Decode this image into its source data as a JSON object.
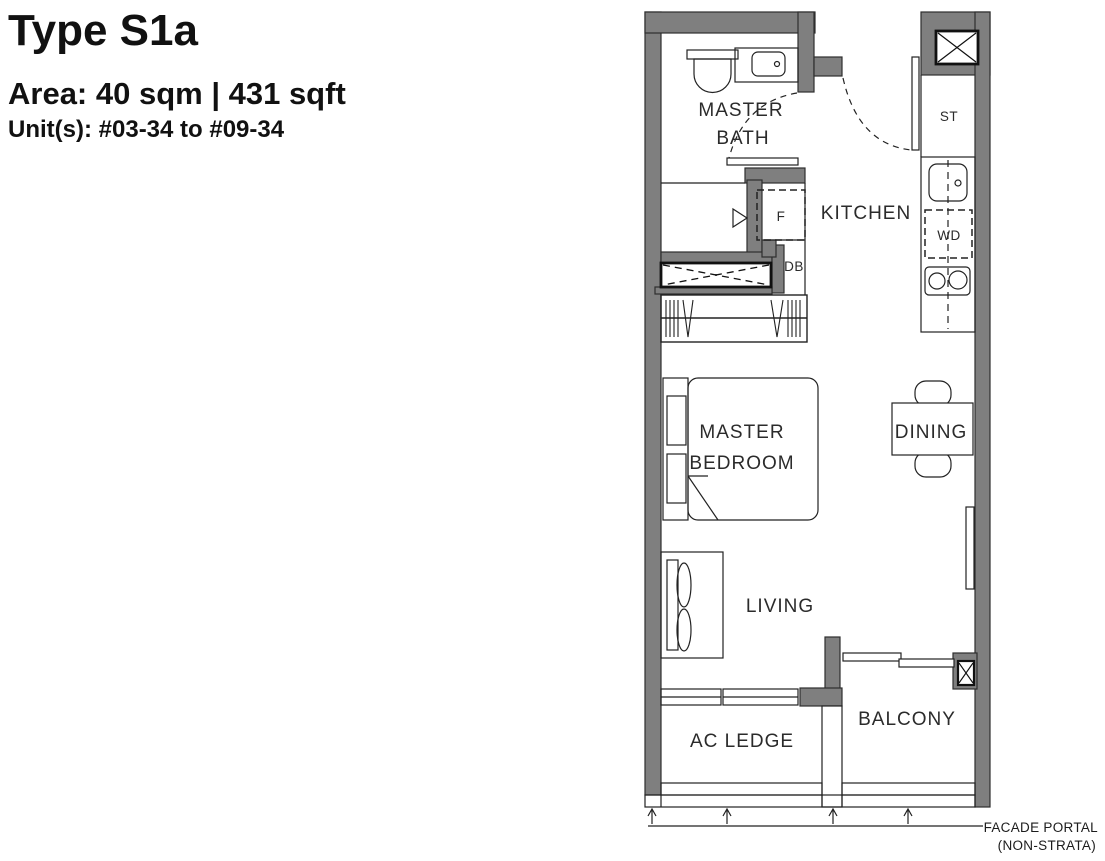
{
  "header": {
    "title": "Type S1a",
    "area": "Area: 40 sqm | 431 sqft",
    "units": "Unit(s): #03-34 to #09-34"
  },
  "plan": {
    "labels": {
      "master_bath_1": "MASTER",
      "master_bath_2": "BATH",
      "kitchen": "KITCHEN",
      "store": "ST",
      "fridge": "F",
      "washer_dryer": "WD",
      "db": "DB",
      "master_bedroom_1": "MASTER",
      "master_bedroom_2": "BEDROOM",
      "dining": "DINING",
      "living": "LIVING",
      "balcony": "BALCONY",
      "ac_ledge": "AC LEDGE",
      "facade_portal_1": "FACADE PORTAL",
      "facade_portal_2": "(NON-STRATA)"
    },
    "colors": {
      "wall_fill": "#7f7f7f",
      "line": "#222222",
      "text": "#2b2b2b",
      "background": "#ffffff"
    }
  }
}
